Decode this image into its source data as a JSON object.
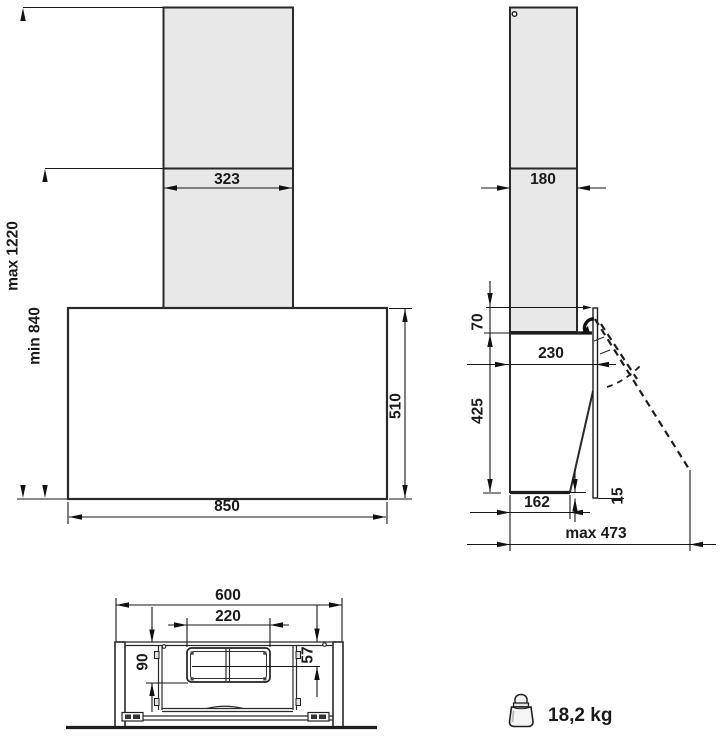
{
  "front_view": {
    "chimney_width_mm": "323",
    "hood_width_mm": "850",
    "hood_height_mm": "510",
    "max_install_height": "max 1220",
    "min_install_height": "min 840"
  },
  "side_view": {
    "chimney_depth_mm": "180",
    "chimney_overlap_mm": "70",
    "hood_depth_mm": "230",
    "hood_height_mm": "425",
    "hood_bottom_depth_mm": "162",
    "panel_overhang_mm": "15",
    "max_open_depth": "max 473"
  },
  "bottom_view": {
    "hood_width_mm": "600",
    "filter_width_mm": "220",
    "filter_depth_mm": "90",
    "offset_mm": "57"
  },
  "weight": {
    "value": "18,2 kg",
    "icon": "weight-icon"
  },
  "colors": {
    "line": "#1a1a1a",
    "chimney_fill": "#e8e8e8",
    "background": "#ffffff"
  }
}
